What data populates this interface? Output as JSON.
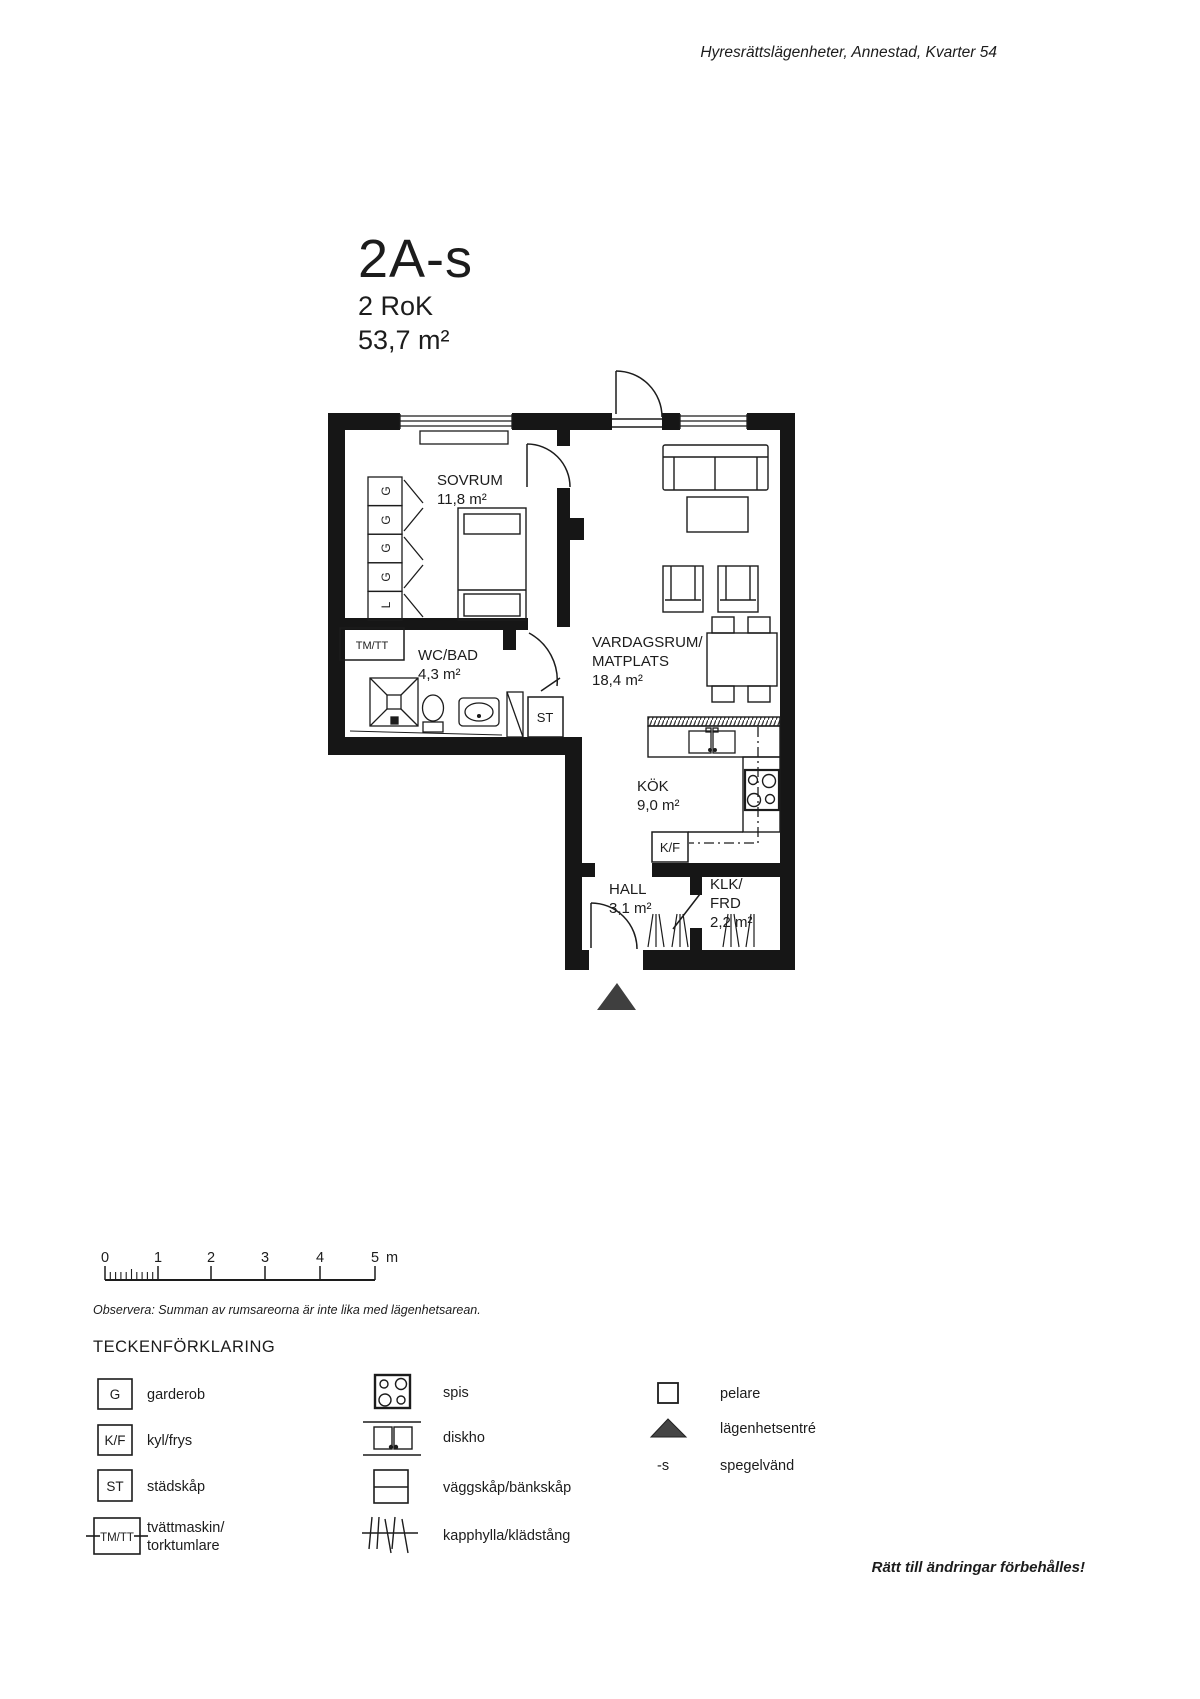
{
  "header": {
    "project": "Hyresrättslägenheter, Annestad, Kvarter 54"
  },
  "title": {
    "id": "2A-s",
    "rooms": "2 RoK",
    "area": "53,7 m²"
  },
  "plan": {
    "sovrum": {
      "name": "SOVRUM",
      "area": "11,8 m²"
    },
    "wcbad": {
      "name": "WC/BAD",
      "area": "4,3 m²"
    },
    "vardagsrum": {
      "name_line1": "VARDAGSRUM/",
      "name_line2": "MATPLATS",
      "area": "18,4 m²"
    },
    "kok": {
      "name": "KÖK",
      "area": "9,0 m²"
    },
    "hall": {
      "name": "HALL",
      "area": "3,1 m²"
    },
    "klk": {
      "name_line1": "KLK/",
      "name_line2": "FRD",
      "area": "2,2 m²"
    },
    "st_label": "ST",
    "kf_label": "K/F",
    "tmtt_label": "TM/TT",
    "wardrobe_labels": [
      "G",
      "G",
      "G",
      "G",
      "L"
    ]
  },
  "scalebar": {
    "tick_labels": [
      "0",
      "1",
      "2",
      "3",
      "4",
      "5"
    ],
    "unit": "m"
  },
  "note": "Observera: Summan av rumsareorna är inte lika med lägenhetsarean.",
  "legend": {
    "title": "TECKENFÖRKLARING",
    "symbol_items": [
      {
        "symbol": "G",
        "label": "garderob"
      },
      {
        "symbol": "K/F",
        "label": "kyl/frys"
      },
      {
        "symbol": "ST",
        "label": "städskåp"
      },
      {
        "symbol": "TM/TT",
        "label_line1": "tvättmaskin/",
        "label_line2": "torktumlare"
      }
    ],
    "icon_items": [
      {
        "icon": "stove-icon",
        "label": "spis"
      },
      {
        "icon": "sink-icon",
        "label": "diskho"
      },
      {
        "icon": "cabinet-icon",
        "label": "väggskåp/bänkskåp"
      },
      {
        "icon": "coat-rack-icon",
        "label": "kapphylla/klädstång"
      }
    ],
    "misc_items": [
      {
        "icon": "pillar-icon",
        "label": "pelare"
      },
      {
        "icon": "entrance-triangle-icon",
        "label": "lägenhetsentré"
      },
      {
        "symbol": "-s",
        "label": "spegelvänd"
      }
    ]
  },
  "footer": {
    "disclaimer": "Rätt till ändringar förbehålles!"
  },
  "colors": {
    "ink": "#1c1c1c",
    "wall": "#161616",
    "entrance_triangle": "#3f3f3f",
    "paper": "#ffffff"
  }
}
